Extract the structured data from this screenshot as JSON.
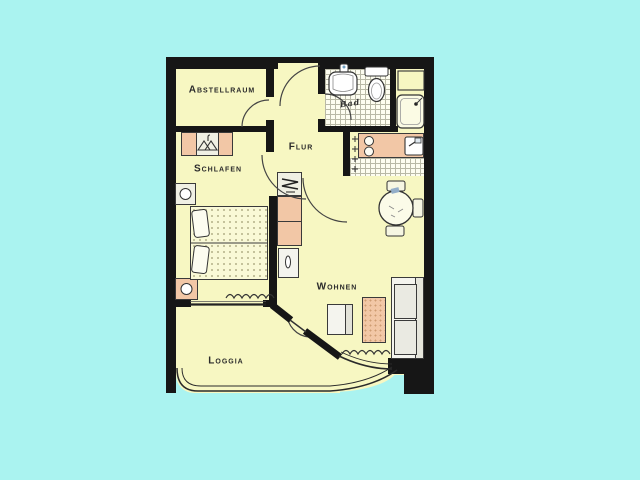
{
  "image": {
    "kind": "scanned apartment floor plan"
  },
  "colors": {
    "background": "#aaf3f0",
    "floor": "#f7f7c2",
    "walls": "#161616",
    "cabinet_pink": "#f2c7a6",
    "cabinet_light": "#f0f0e4",
    "tile_floor": "#fdfdf0",
    "outline": "#333333"
  },
  "rooms": {
    "abstellraum": {
      "label": "Abstellraum"
    },
    "schlafen": {
      "label": "Schlafen"
    },
    "flur": {
      "label": "Flur"
    },
    "bad": {
      "label": "Bad"
    },
    "wohnen": {
      "label": "Wohnen"
    },
    "loggia": {
      "label": "Loggia"
    }
  }
}
